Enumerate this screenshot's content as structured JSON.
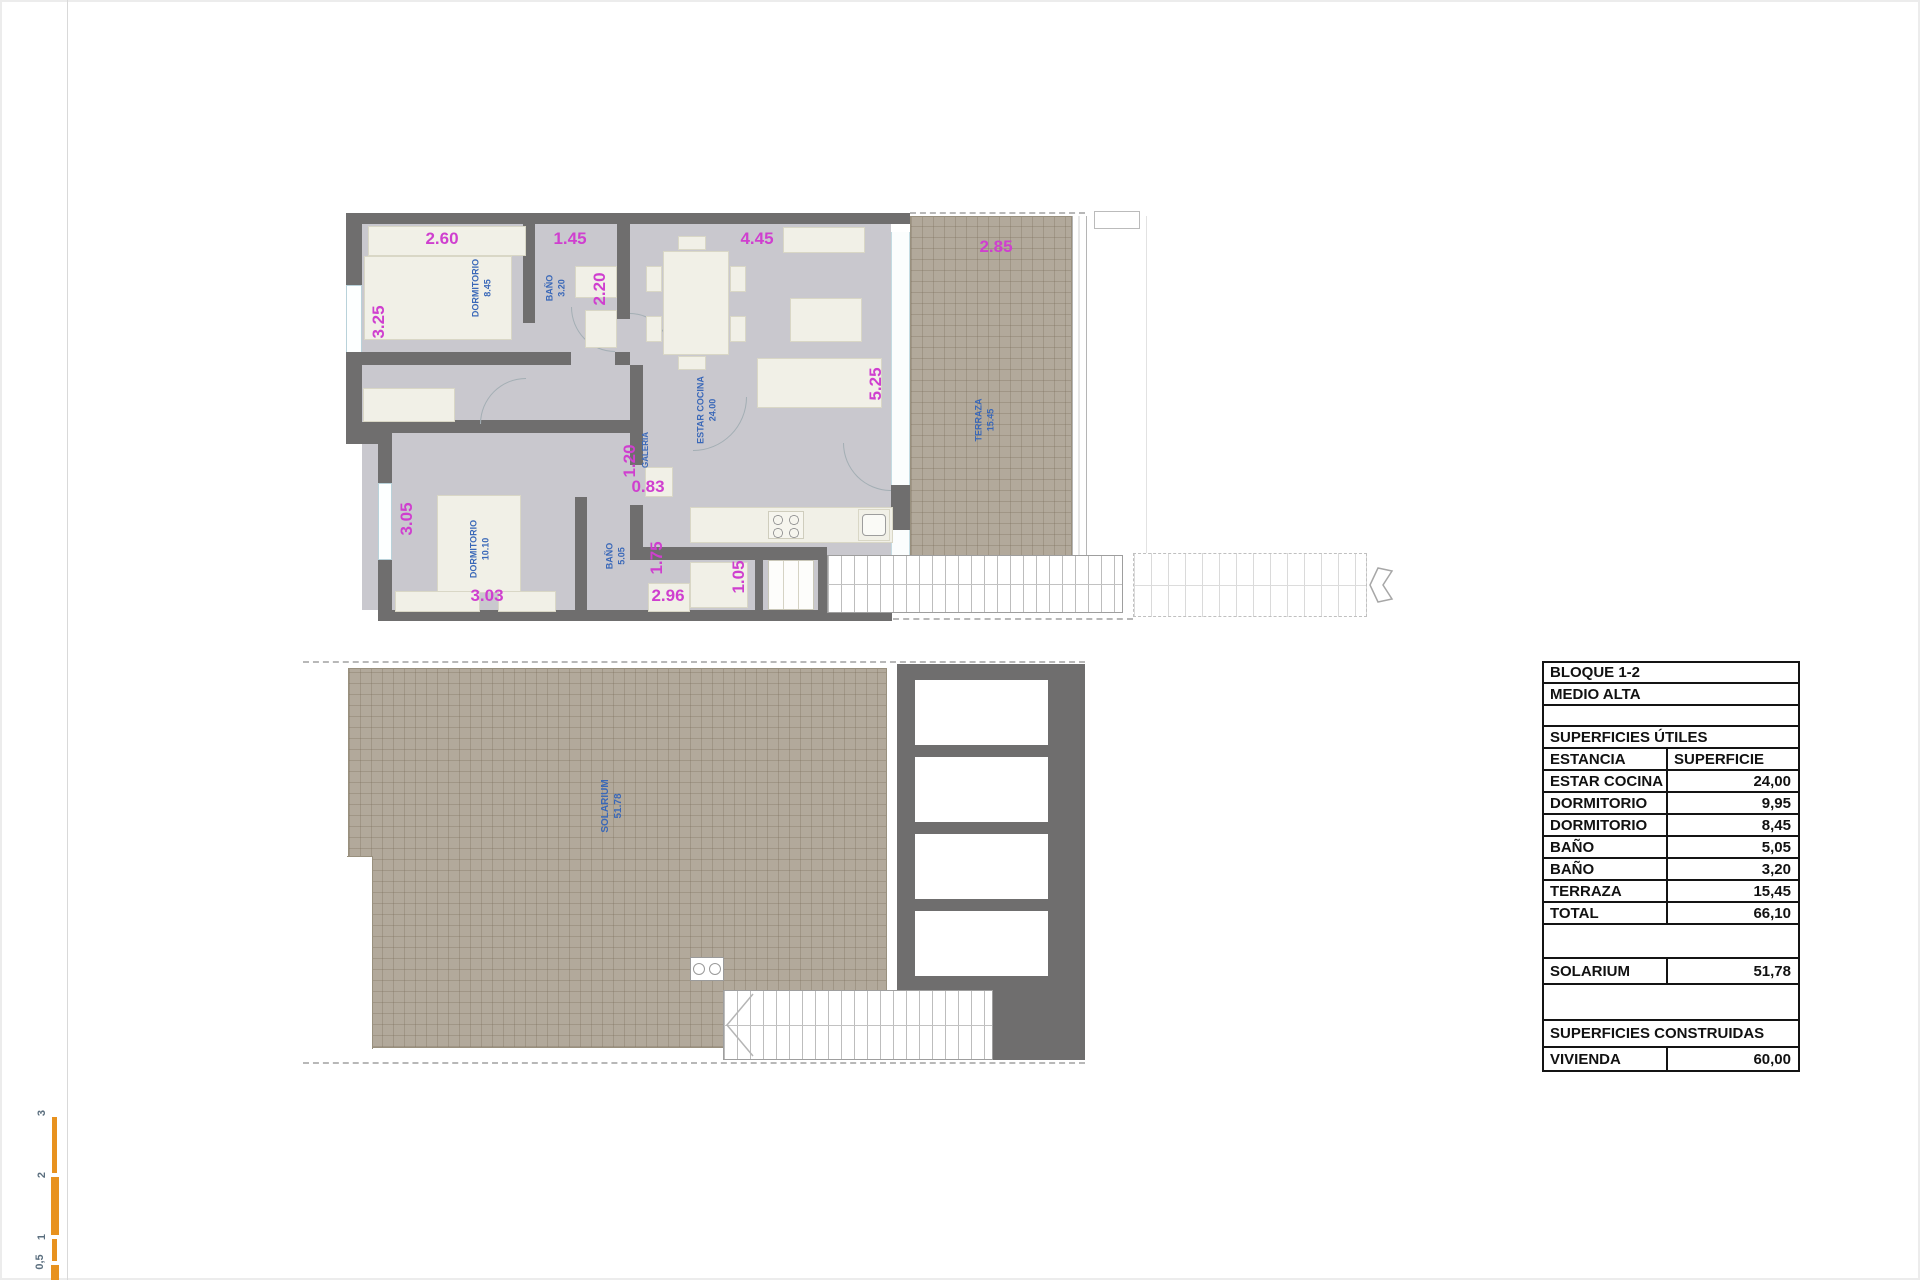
{
  "colors": {
    "wall": "#6f6e6e",
    "floor": "#c9c8ce",
    "terrace": "#b2a99b",
    "furniture": "#f1f0e7",
    "dimension_text": "#cf3fcf",
    "room_label_text": "#3a68b8",
    "table_border": "#141414",
    "scale_bar": "#e8921f",
    "window_glass": "#c3dbe2"
  },
  "upper_plan": {
    "rooms": [
      {
        "name": "DORMITORIO",
        "area": "8.45"
      },
      {
        "name": "BAÑO",
        "area": "3.20"
      },
      {
        "name": "ESTAR COCINA",
        "area": "24.00"
      },
      {
        "name": "TERRAZA",
        "area": "15.45"
      },
      {
        "name": "DORMITORIO",
        "area": "10.10"
      },
      {
        "name": "BAÑO",
        "area": "5.05"
      },
      {
        "name": "GALERIA",
        "area": ""
      }
    ],
    "dimensions": [
      "2.60",
      "1.45",
      "4.45",
      "2.85",
      "3.25",
      "2.20",
      "5.25",
      "1.20",
      "0.83",
      "3.05",
      "1.75",
      "1.05",
      "3.03",
      "2.96"
    ]
  },
  "lower_plan": {
    "rooms": [
      {
        "name": "SOLARIUM",
        "area": "51.78"
      }
    ]
  },
  "summary_table": {
    "rows": [
      {
        "label": "BLOQUE 1-2",
        "value": ""
      },
      {
        "label": "MEDIO ALTA",
        "value": ""
      },
      {
        "label": "",
        "value": ""
      },
      {
        "label": "SUPERFICIES ÚTILES",
        "value": ""
      },
      {
        "label": "ESTANCIA",
        "value": "SUPERFICIE"
      },
      {
        "label": "ESTAR COCINA",
        "value": "24,00"
      },
      {
        "label": "DORMITORIO",
        "value": "9,95"
      },
      {
        "label": "DORMITORIO",
        "value": "8,45"
      },
      {
        "label": "BAÑO",
        "value": "5,05"
      },
      {
        "label": "BAÑO",
        "value": "3,20"
      },
      {
        "label": "TERRAZA",
        "value": "15,45"
      },
      {
        "label": "TOTAL",
        "value": "66,10"
      },
      {
        "label": "",
        "value": ""
      },
      {
        "label": "SOLARIUM",
        "value": "51,78"
      },
      {
        "label": "",
        "value": ""
      },
      {
        "label": "SUPERFICIES CONSTRUIDAS",
        "value": ""
      },
      {
        "label": "VIVIENDA",
        "value": "60,00"
      }
    ]
  },
  "scale_bar": {
    "labels": [
      "3",
      "2",
      "1",
      "0,5"
    ]
  }
}
